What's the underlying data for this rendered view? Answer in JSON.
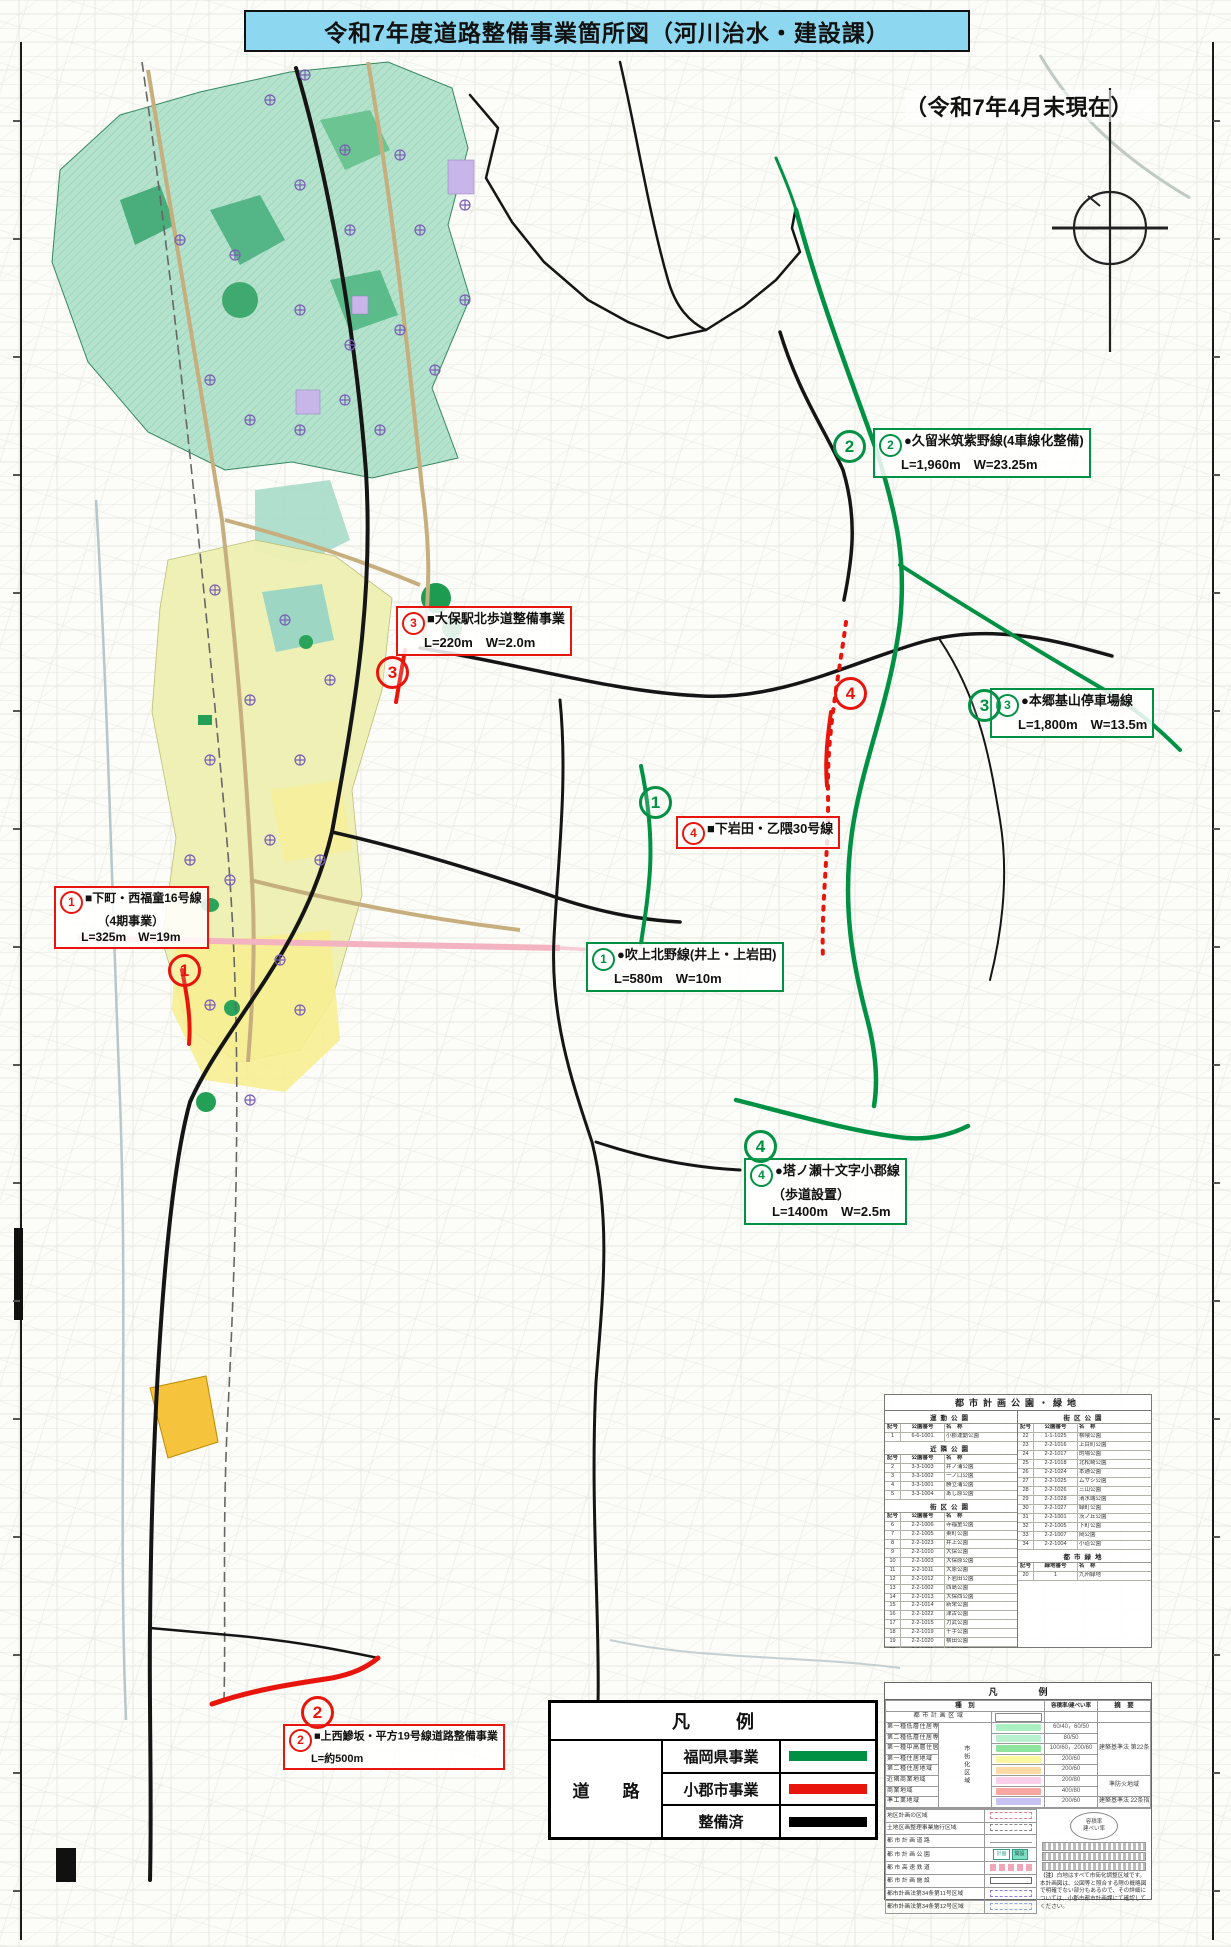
{
  "title": "令和7年度道路整備事業箇所図（河川治水・建設課）",
  "date_note": "（令和7年4月末現在）",
  "colors": {
    "title_bg": "#8ed7f0",
    "pref_green": "#009144",
    "city_red": "#e8150c",
    "done_black": "#000000"
  },
  "callouts": [
    {
      "key": "kurume",
      "num": "2",
      "type": "pref",
      "lines": [
        "●久留米筑紫野線(4車線化整備)",
        "L=1,960m　W=23.25m"
      ]
    },
    {
      "key": "oho",
      "num": "3",
      "type": "city",
      "lines": [
        "■大保駅北歩道整備事業",
        "L=220m　W=2.0m"
      ]
    },
    {
      "key": "hongo",
      "num": "3",
      "type": "pref",
      "lines": [
        "●本郷基山停車場線",
        "L=1,800m　W=13.5m"
      ]
    },
    {
      "key": "shimoiwata",
      "num": "4",
      "type": "city",
      "lines": [
        "■下岩田・乙隈30号線"
      ]
    },
    {
      "key": "fukiage",
      "num": "1",
      "type": "pref",
      "lines": [
        "●吹上北野線(井上・上岩田)",
        "L=580m　W=10m"
      ]
    },
    {
      "key": "shimomachi",
      "num": "1",
      "type": "city",
      "lines": [
        "■下町・西福童16号線",
        "（4期事業）",
        "L=325m　W=19m"
      ]
    },
    {
      "key": "tonose",
      "num": "4",
      "type": "pref",
      "lines": [
        "●塔ノ瀬十文字小郡線",
        "（歩道設置）",
        "L=1400m　W=2.5m"
      ]
    },
    {
      "key": "kaminishi",
      "num": "2",
      "type": "city",
      "lines": [
        "■上西鰺坂・平方19号線道路整備事業",
        "L=約500m"
      ]
    }
  ],
  "map_markers": [
    {
      "key": "pref2",
      "num": "2",
      "type": "pref"
    },
    {
      "key": "city3",
      "num": "3",
      "type": "city"
    },
    {
      "key": "pref3",
      "num": "3",
      "type": "pref"
    },
    {
      "key": "city4",
      "num": "4",
      "type": "city"
    },
    {
      "key": "pref1",
      "num": "1",
      "type": "pref"
    },
    {
      "key": "city1",
      "num": "1",
      "type": "city"
    },
    {
      "key": "pref4",
      "num": "4",
      "type": "pref"
    },
    {
      "key": "city2",
      "num": "2",
      "type": "city"
    }
  ],
  "road_legend": {
    "title": "凡　例",
    "category": "道　路",
    "items": [
      {
        "label": "福岡県事業",
        "color": "#009144"
      },
      {
        "label": "小郡市事業",
        "color": "#e8150c"
      },
      {
        "label": "整備済",
        "color": "#000000"
      }
    ]
  },
  "park_table": {
    "title": "都市計画公園・緑地",
    "left_sections": [
      {
        "header": "運動公園",
        "cols": [
          "記号",
          "公園番号",
          "名　称"
        ],
        "rows": [
          [
            "1",
            "6-6-1001",
            "小郡運動公園"
          ]
        ]
      },
      {
        "header": "近隣公園",
        "cols": [
          "記号",
          "公園番号",
          "名　称"
        ],
        "rows": [
          [
            "2",
            "3-3-1003",
            "井ノ浦公園"
          ],
          [
            "3",
            "3-3-1002",
            "一ノ口公園"
          ],
          [
            "4",
            "3-3-1001",
            "勝立浦公園"
          ],
          [
            "5",
            "3-3-1004",
            "あし原公園"
          ]
        ]
      },
      {
        "header": "街区公園",
        "cols": [
          "記号",
          "公園番号",
          "名　称"
        ],
        "rows": [
          [
            "6",
            "2-2-1006",
            "寺福童公園"
          ],
          [
            "7",
            "2-2-1005",
            "東町公園"
          ],
          [
            "8",
            "2-2-1023",
            "井上公園"
          ],
          [
            "9",
            "2-2-1010",
            "大保公園"
          ],
          [
            "10",
            "2-2-1003",
            "大保原公園"
          ],
          [
            "11",
            "2-2-1011",
            "大原公園"
          ],
          [
            "12",
            "2-2-1012",
            "下岩田公園"
          ],
          [
            "13",
            "2-2-1002",
            "西島公園"
          ],
          [
            "14",
            "2-2-1013",
            "大保西公園"
          ],
          [
            "15",
            "2-2-1014",
            "新栄公園"
          ],
          [
            "16",
            "2-2-1022",
            "津古公園"
          ],
          [
            "17",
            "2-2-1015",
            "力武公園"
          ],
          [
            "18",
            "2-2-1019",
            "千手公園"
          ],
          [
            "19",
            "2-2-1020",
            "横田公園"
          ],
          [
            "20",
            "2-2-1021",
            "上町公園"
          ],
          [
            "21",
            "2-2-1008",
            "北浦公園"
          ]
        ]
      }
    ],
    "right_sections": [
      {
        "header": "街区公園",
        "cols": [
          "記号",
          "公園番号",
          "名　称"
        ],
        "rows": [
          [
            "22",
            "1-1-1025",
            "横隈公園"
          ],
          [
            "23",
            "2-2-1016",
            "上目町公園"
          ],
          [
            "24",
            "2-2-1017",
            "的場公園"
          ],
          [
            "25",
            "2-2-1018",
            "北松崎公園"
          ],
          [
            "26",
            "2-2-1024",
            "本通公園"
          ],
          [
            "27",
            "2-2-1025",
            "ムサシ公園"
          ],
          [
            "28",
            "2-2-1026",
            "三山公園"
          ],
          [
            "29",
            "2-2-1028",
            "清水端公園"
          ],
          [
            "30",
            "2-2-1027",
            "緑町公園"
          ],
          [
            "31",
            "2-2-1001",
            "茨ノ丘公園"
          ],
          [
            "32",
            "2-2-1005",
            "下町公園"
          ],
          [
            "33",
            "2-2-1007",
            "岡公園"
          ],
          [
            "34",
            "2-2-1004",
            "小道公園"
          ]
        ]
      },
      {
        "header": "都市緑地",
        "cols": [
          "記号",
          "緑地番号",
          "名　称"
        ],
        "rows": [
          [
            "20",
            "1",
            "九州緑地"
          ]
        ]
      }
    ]
  },
  "zoning_legend": {
    "title": "凡　例",
    "col_headers": [
      "種　別",
      "容積率/建ぺい率",
      "摘　要"
    ],
    "vertical_label": "市街化区域",
    "area_row_label": "都 市 計 画 区 域",
    "zone_rows": [
      {
        "label": "第一種低層住居専用地域",
        "color": "#abefc3",
        "ratio": "60/40，60/50"
      },
      {
        "label": "第二種低層住居専用地域",
        "color": "#b9f0cd",
        "ratio": "80/50"
      },
      {
        "label": "第一種中高層住居専用地域",
        "color": "#8fe49d",
        "ratio": "100/60，200/60"
      },
      {
        "label": "第一種住居地域",
        "color": "#f9f7a0",
        "ratio": "200/60"
      },
      {
        "label": "第二種住居地域",
        "color": "#fcd9a5",
        "ratio": "200/60"
      },
      {
        "label": "近隣商業地域",
        "color": "#fbcfe9",
        "ratio": "200/80"
      },
      {
        "label": "商業地域",
        "color": "#f7a8a3",
        "ratio": "400/80"
      },
      {
        "label": "準工業地域",
        "color": "#c9c3f3",
        "ratio": "200/60"
      }
    ],
    "zone_notes": [
      {
        "row": 0,
        "span": 5,
        "text": "建築基準法 第22条 指定区域"
      },
      {
        "row": 5,
        "span": 2,
        "text": "準防火地域"
      },
      {
        "row": 7,
        "span": 1,
        "text": "建築基準法 22条指定区域"
      }
    ],
    "facility_rows": [
      {
        "label": "地区計画の区域",
        "swatch": "dash-red"
      },
      {
        "label": "土地区画整理事業施行区域",
        "swatch": "dash-black"
      },
      {
        "label": "都 市 計 画 道 路",
        "swatch": "line-arrow"
      },
      {
        "label": "都 市 計 画 公 園",
        "swatch": "park"
      },
      {
        "label": "都 市 高 速 鉄 道",
        "swatch": "rail"
      },
      {
        "label": "都 市 計 画 施 設",
        "swatch": "box"
      },
      {
        "label": "都市計画法第34条第11号区域",
        "swatch": "dash-purple"
      },
      {
        "label": "都市計画法第34条第12号区域",
        "swatch": "dash-blue"
      }
    ],
    "park_chip_labels": [
      "計画",
      "開設"
    ],
    "ratio_circle": [
      "容積率",
      "建ぺい率"
    ],
    "note_title": "（注）",
    "note_body": "白地はすべて市街化調整区域です。本計画図は、公図等と照合する際の概略図で明確でない部分もあるので、その詳細については、小郡市都市計画課にて確認してください。"
  }
}
